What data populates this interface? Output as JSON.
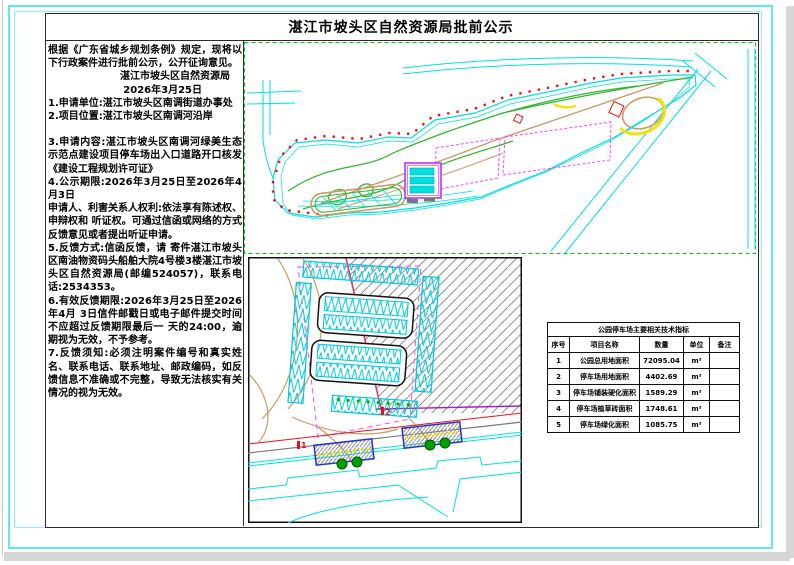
{
  "page": {
    "title": "湛江市坡头区自然资源局批前公示"
  },
  "notice": {
    "intro": "根据《广东省城乡规划条例》规定，现将以下行政案件进行批前公示，公开征询意见。",
    "issuer": "湛江市坡头区自然资源局",
    "issue_date": "2026年3月25日",
    "item1": "1.申请单位:湛江市坡头区南调街道办事处",
    "item2": "2.项目位置:湛江市坡头区南调河沿岸",
    "item3": "3.申请内容:湛江市坡头区南调河绿美生态示范点建设项目停车场出入口道路开口核发《建设工程规划许可证》",
    "item4": "4.公示期限:2026年3月25日至2026年4月3日",
    "rights": "申请人、利害关系人权利:依法享有陈述权、申辩权和 听证权。可通过信函或网络的方式反馈意见或者提出听证申请。",
    "item5": "5.反馈方式:信函反馈，请 寄件湛江市坡头区南油物资码头船舶大院4号楼3楼湛江市坡头区自然资源局(邮编524057)，联系电话:2534353。",
    "item6": "6.有效反馈期限:2026年3月25日至2026年4月 3日信件邮戳日或电子邮件提交时间不应超过反馈期限最后一 天的24:00，逾期视为无效，不予参考。",
    "item7": "7.反馈须知:必须注明案件编号和真实姓名、联系电话、联系地址、邮政编码，如反馈信息不准确或不完整，导致无法核实有关情况的视为无效。"
  },
  "indicator_table": {
    "title": "公园停车场主要相关技术指标",
    "headers": {
      "no": "序号",
      "name": "项目名称",
      "qty": "数量",
      "unit": "单位",
      "remark": "备注"
    },
    "rows": [
      {
        "no": "1",
        "name": "公园总用地面积",
        "qty": "72095.04",
        "unit": "m²",
        "remark": ""
      },
      {
        "no": "2",
        "name": "停车场用地面积",
        "qty": "4402.69",
        "unit": "m²",
        "remark": ""
      },
      {
        "no": "3",
        "name": "停车场铺装硬化面积",
        "qty": "1589.29",
        "unit": "m²",
        "remark": ""
      },
      {
        "no": "4",
        "name": "停车场植草砖面积",
        "qty": "1748.61",
        "unit": "m²",
        "remark": ""
      },
      {
        "no": "5",
        "name": "停车场绿化面积",
        "qty": "1085.75",
        "unit": "m²",
        "remark": ""
      }
    ]
  },
  "drawings": {
    "entrance_marker_1": "1",
    "entrance_marker_2": "2"
  },
  "palette": {
    "cyan": "#00e0e0",
    "magenta": "#ff44ff",
    "green": "#2db42d",
    "tan": "#cc9a66",
    "red": "#ee1111",
    "yellow": "#f2e400",
    "purple": "#a020c0",
    "crimson": "#e8336e",
    "blue": "#2233cc",
    "hatch_gray": "#9a9a9a"
  }
}
